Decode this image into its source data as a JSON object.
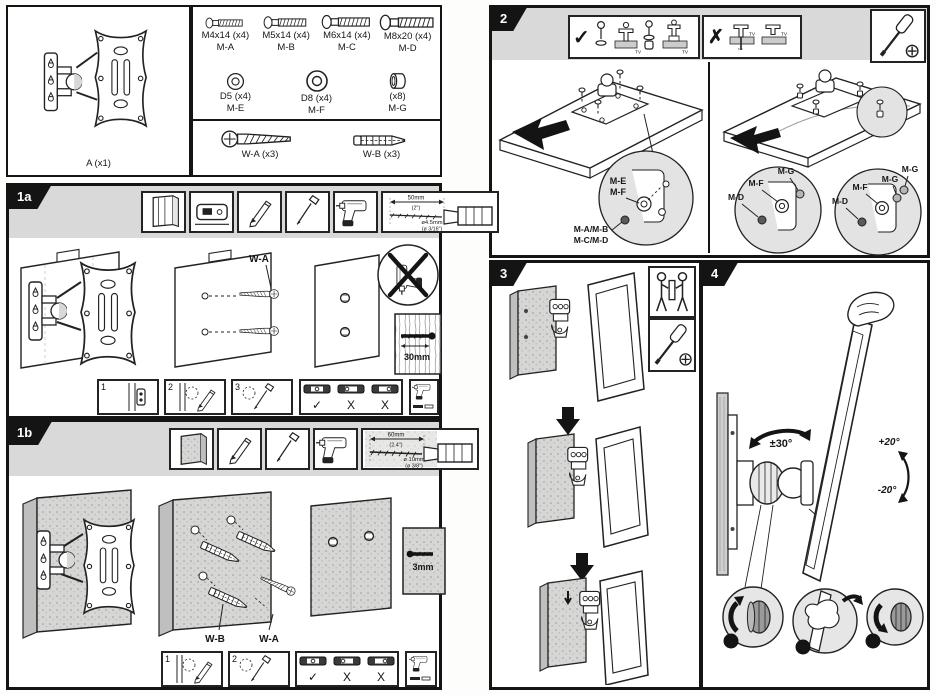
{
  "colors": {
    "ink": "#161616",
    "panel_gray": "#d9d9d9",
    "wall_gray": "#cfcfcf",
    "detail_gray": "#e3e3e3"
  },
  "parts_panel": {
    "bracket_label": "A (x1)",
    "screws": [
      {
        "size": "M4x14 (x4)",
        "code": "M-A"
      },
      {
        "size": "M5x14 (x4)",
        "code": "M-B"
      },
      {
        "size": "M6x14 (x4)",
        "code": "M-C"
      },
      {
        "size": "M8x20 (x4)",
        "code": "M-D"
      }
    ],
    "spacers": [
      {
        "size": "D5 (x4)",
        "code": "M-E"
      },
      {
        "size": "D8 (x4)",
        "code": "M-F"
      },
      {
        "size": "(x8)",
        "code": "M-G"
      }
    ],
    "wall_hardware": [
      {
        "label": "W-A (x3)"
      },
      {
        "label": "W-B (x3)"
      }
    ]
  },
  "step_1a": {
    "tab": "1a",
    "drill_spec": {
      "depth": "50mm",
      "depth_alt": "(2\")",
      "diameter": "ø4.5mm",
      "diameter_alt": "(ø 3/16\")"
    },
    "screw_callout": "W-A",
    "depth_note": "30mm",
    "substeps": [
      "1",
      "2",
      "3"
    ],
    "level_checks": [
      "✓",
      "X",
      "X"
    ]
  },
  "step_1b": {
    "tab": "1b",
    "drill_spec": {
      "depth": "60mm",
      "depth_alt": "(2.4\")",
      "diameter": "ø 10mm",
      "diameter_alt": "(ø 3/8\")"
    },
    "anchor_callout": "W-B",
    "screw_callout": "W-A",
    "depth_note": "3mm",
    "substeps": [
      "1",
      "2"
    ],
    "level_checks": [
      "✓",
      "X",
      "X"
    ]
  },
  "step_2": {
    "tab": "2",
    "ok_mark": "✓",
    "bad_mark": "✗",
    "tv_tag": "TV",
    "flat_back": {
      "washer_a": "M-E",
      "washer_b": "M-F",
      "screws_ab": "M-A/M-B",
      "screws_cd": "M-C/M-D"
    },
    "curved_back_left": [
      "M-G",
      "M-F",
      "M-D"
    ],
    "curved_back_right": [
      "M-G",
      "M-G",
      "M-F",
      "M-D"
    ]
  },
  "step_3": {
    "tab": "3"
  },
  "step_4": {
    "tab": "4",
    "swivel_range": "±30°",
    "tilt_up": "+20°",
    "tilt_down": "-20°",
    "adjust_steps": [
      "1",
      "2",
      "3"
    ]
  }
}
